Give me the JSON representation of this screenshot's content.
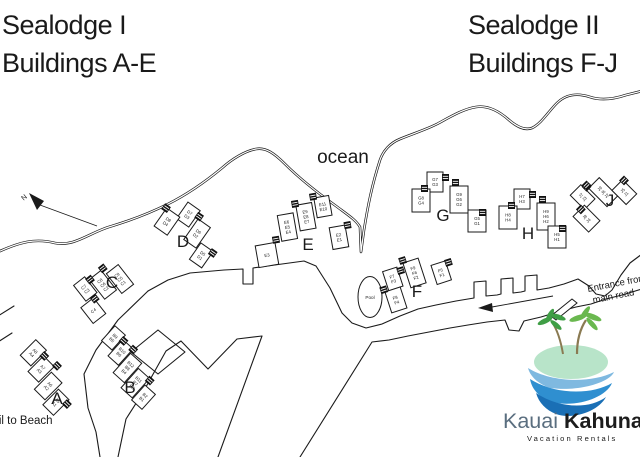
{
  "titles": {
    "sealodge1": {
      "line1": "Sealodge I",
      "line2": "Buildings A-E"
    },
    "sealodge2": {
      "line1": "Sealodge II",
      "line2": "Buildings F-J"
    }
  },
  "map_labels": {
    "ocean": "ocean",
    "pool": "Pool",
    "trail_to_beach": "Trail to Beach",
    "north": "N",
    "entrance_line1": "Entrance from",
    "entrance_line2": "main road"
  },
  "buildings": [
    {
      "letter": "A",
      "segments": [
        [
          "A8",
          "A4"
        ],
        [
          "A7",
          "A3"
        ],
        [
          "A6",
          "A2"
        ],
        [
          "A5",
          "A1"
        ]
      ]
    },
    {
      "letter": "B",
      "segments": [
        [
          "B9",
          "B5"
        ],
        [
          "B10",
          "B6"
        ],
        [
          "B12",
          "B8",
          "B4"
        ],
        [
          "B11",
          "B7",
          "B3"
        ],
        [
          "B2",
          "B1"
        ]
      ]
    },
    {
      "letter": "C",
      "segments": [
        [
          "C4"
        ],
        [
          "C7",
          "C3"
        ],
        [
          "C8",
          "C6",
          "C2"
        ],
        [
          "C9",
          "C5",
          "C1"
        ]
      ]
    },
    {
      "letter": "D",
      "segments": [
        [
          "D7",
          "D3"
        ],
        [
          "D8",
          "D4"
        ],
        [
          "D6",
          "D2"
        ],
        [
          "D5",
          "D1"
        ]
      ]
    },
    {
      "letter": "E",
      "segments": [
        [
          "E3"
        ],
        [
          "E6",
          "E5",
          "E4"
        ],
        [
          "E9",
          "E8",
          "E7"
        ],
        [
          "E11",
          "E10"
        ],
        [
          "E2",
          "E1"
        ]
      ]
    },
    {
      "letter": "F",
      "segments": [
        [
          "F7",
          "F3"
        ],
        [
          "F8",
          "F4"
        ],
        [
          "F9",
          "F6",
          "F2"
        ],
        [
          "F5",
          "F1"
        ]
      ]
    },
    {
      "letter": "G",
      "segments": [
        [
          "G7",
          "G3"
        ],
        [
          "G8",
          "G4"
        ],
        [
          "G9",
          "G6",
          "G2"
        ],
        [
          "G5",
          "G1"
        ]
      ]
    },
    {
      "letter": "H",
      "segments": [
        [
          "H7",
          "H3"
        ],
        [
          "H8",
          "H4"
        ],
        [
          "H9",
          "H6",
          "H2"
        ],
        [
          "H5",
          "H1"
        ]
      ]
    },
    {
      "letter": "J",
      "segments": [
        [
          "J7",
          "J3"
        ],
        [
          "J8",
          "J4"
        ],
        [
          "J9",
          "J6",
          "J2"
        ],
        [
          "J5",
          "J1"
        ]
      ]
    }
  ],
  "logo": {
    "brand_first": "Kauai ",
    "brand_second": "Kahuna",
    "tagline": "Vacation Rentals"
  },
  "colors": {
    "line": "#1a1a1a",
    "logo_island": "#b8e4c9",
    "logo_palm_dark": "#3f9e45",
    "logo_palm_light": "#6ab84f",
    "logo_trunk": "#8a7a52",
    "logo_wave_dark": "#1a6fb5",
    "logo_wave_mid": "#2f8fd0",
    "logo_wave_light": "#7fb9e0",
    "logo_kauai_text": "#5a6e7f",
    "logo_kahuna_text": "#1c1c1c",
    "logo_tagline_text": "#7d9a3c"
  }
}
